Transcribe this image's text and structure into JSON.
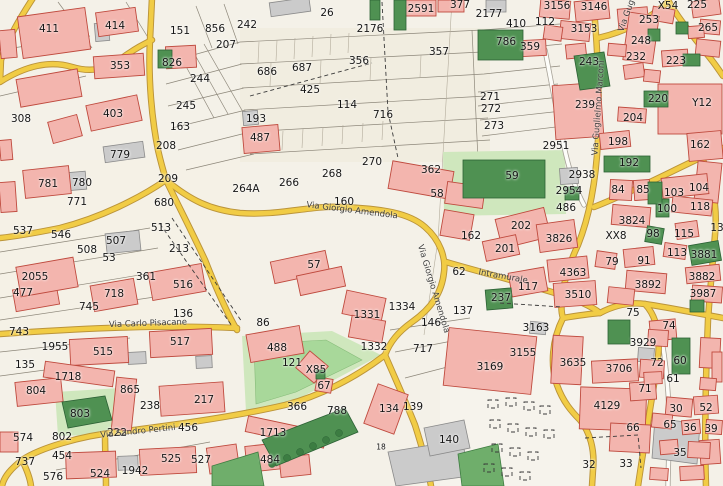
{
  "map": {
    "type": "cadastral-street-map",
    "palette": {
      "bg": "#f4f1e8",
      "road_yellow": "#f1cc45",
      "road_casing": "#bb943a",
      "building_pink": "#f3b5ae",
      "building_outline": "#bf4a3e",
      "green_dark": "#4f9152",
      "green_light": "#cfe7bd",
      "label_color": "#161616"
    },
    "street_labels": [
      {
        "text": "Via Giorgio Amendola",
        "x": 352,
        "y": 211,
        "angle": 7
      },
      {
        "text": "Via Giorgio Amendola",
        "x": 433,
        "y": 289,
        "angle": 73
      },
      {
        "text": "Via Guglielmo Marconi",
        "x": 599,
        "y": 108,
        "angle": -86
      },
      {
        "text": "Via Gug",
        "x": 627,
        "y": 16,
        "angle": -70
      },
      {
        "text": "Via Carlo Pisacane",
        "x": 148,
        "y": 324,
        "angle": -2
      },
      {
        "text": "Via Sandro Pertini",
        "x": 138,
        "y": 432,
        "angle": -6
      },
      {
        "text": "Intramurale",
        "x": 503,
        "y": 277,
        "angle": 10
      }
    ],
    "parcel_labels": [
      {
        "t": "411",
        "x": 49,
        "y": 29
      },
      {
        "t": "414",
        "x": 115,
        "y": 26
      },
      {
        "t": "151",
        "x": 180,
        "y": 31
      },
      {
        "t": "856",
        "x": 215,
        "y": 29
      },
      {
        "t": "242",
        "x": 247,
        "y": 25
      },
      {
        "t": "26",
        "x": 327,
        "y": 13
      },
      {
        "t": "2591",
        "x": 421,
        "y": 9
      },
      {
        "t": "377",
        "x": 460,
        "y": 5
      },
      {
        "t": "2176",
        "x": 370,
        "y": 29
      },
      {
        "t": "207",
        "x": 226,
        "y": 45
      },
      {
        "t": "353",
        "x": 120,
        "y": 66
      },
      {
        "t": "826",
        "x": 172,
        "y": 63
      },
      {
        "t": "244",
        "x": 200,
        "y": 79
      },
      {
        "t": "245",
        "x": 186,
        "y": 106
      },
      {
        "t": "403",
        "x": 113,
        "y": 114
      },
      {
        "t": "308",
        "x": 21,
        "y": 119
      },
      {
        "t": "163",
        "x": 180,
        "y": 127
      },
      {
        "t": "208",
        "x": 166,
        "y": 146
      },
      {
        "t": "779",
        "x": 120,
        "y": 155
      },
      {
        "t": "686",
        "x": 267,
        "y": 72
      },
      {
        "t": "687",
        "x": 302,
        "y": 68
      },
      {
        "t": "356",
        "x": 359,
        "y": 61
      },
      {
        "t": "357",
        "x": 439,
        "y": 52
      },
      {
        "t": "425",
        "x": 310,
        "y": 90
      },
      {
        "t": "114",
        "x": 347,
        "y": 105
      },
      {
        "t": "716",
        "x": 383,
        "y": 115
      },
      {
        "t": "193",
        "x": 256,
        "y": 119
      },
      {
        "t": "487",
        "x": 260,
        "y": 138
      },
      {
        "t": "270",
        "x": 372,
        "y": 162
      },
      {
        "t": "264A",
        "x": 246,
        "y": 189
      },
      {
        "t": "266",
        "x": 289,
        "y": 183
      },
      {
        "t": "268",
        "x": 332,
        "y": 174
      },
      {
        "t": "160",
        "x": 344,
        "y": 202
      },
      {
        "t": "2177",
        "x": 489,
        "y": 14
      },
      {
        "t": "410",
        "x": 516,
        "y": 24
      },
      {
        "t": "112",
        "x": 545,
        "y": 22
      },
      {
        "t": "3156",
        "x": 557,
        "y": 6
      },
      {
        "t": "3146",
        "x": 594,
        "y": 7
      },
      {
        "t": "X54",
        "x": 668,
        "y": 6
      },
      {
        "t": "225",
        "x": 697,
        "y": 5
      },
      {
        "t": "3153",
        "x": 584,
        "y": 29
      },
      {
        "t": "253",
        "x": 649,
        "y": 20
      },
      {
        "t": "265",
        "x": 708,
        "y": 28
      },
      {
        "t": "786",
        "x": 506,
        "y": 42
      },
      {
        "t": "359",
        "x": 530,
        "y": 47
      },
      {
        "t": "248",
        "x": 641,
        "y": 41
      },
      {
        "t": "232",
        "x": 636,
        "y": 57
      },
      {
        "t": "223",
        "x": 676,
        "y": 61
      },
      {
        "t": "243",
        "x": 589,
        "y": 62
      },
      {
        "t": "271",
        "x": 490,
        "y": 97
      },
      {
        "t": "272",
        "x": 491,
        "y": 109
      },
      {
        "t": "273",
        "x": 494,
        "y": 126
      },
      {
        "t": "239",
        "x": 585,
        "y": 105
      },
      {
        "t": "220",
        "x": 658,
        "y": 99
      },
      {
        "t": "Y12",
        "x": 702,
        "y": 103
      },
      {
        "t": "204",
        "x": 633,
        "y": 118
      },
      {
        "t": "198",
        "x": 618,
        "y": 142
      },
      {
        "t": "2951",
        "x": 556,
        "y": 146
      },
      {
        "t": "192",
        "x": 629,
        "y": 163
      },
      {
        "t": "162",
        "x": 700,
        "y": 145
      },
      {
        "t": "362",
        "x": 431,
        "y": 170
      },
      {
        "t": "58",
        "x": 437,
        "y": 194
      },
      {
        "t": "59",
        "x": 512,
        "y": 176
      },
      {
        "t": "781",
        "x": 48,
        "y": 184
      },
      {
        "t": "780",
        "x": 82,
        "y": 183
      },
      {
        "t": "771",
        "x": 77,
        "y": 202
      },
      {
        "t": "209",
        "x": 168,
        "y": 179
      },
      {
        "t": "680",
        "x": 164,
        "y": 203
      },
      {
        "t": "537",
        "x": 23,
        "y": 231
      },
      {
        "t": "546",
        "x": 61,
        "y": 235
      },
      {
        "t": "513",
        "x": 161,
        "y": 228
      },
      {
        "t": "507",
        "x": 116,
        "y": 241
      },
      {
        "t": "508",
        "x": 87,
        "y": 250
      },
      {
        "t": "53",
        "x": 109,
        "y": 258
      },
      {
        "t": "213",
        "x": 179,
        "y": 249
      },
      {
        "t": "2055",
        "x": 35,
        "y": 277
      },
      {
        "t": "477",
        "x": 23,
        "y": 293
      },
      {
        "t": "718",
        "x": 114,
        "y": 294
      },
      {
        "t": "361",
        "x": 146,
        "y": 277
      },
      {
        "t": "516",
        "x": 183,
        "y": 285
      },
      {
        "t": "136",
        "x": 183,
        "y": 314
      },
      {
        "t": "745",
        "x": 89,
        "y": 307
      },
      {
        "t": "57",
        "x": 314,
        "y": 265
      },
      {
        "t": "162",
        "x": 471,
        "y": 236
      },
      {
        "t": "202",
        "x": 521,
        "y": 226
      },
      {
        "t": "201",
        "x": 505,
        "y": 249
      },
      {
        "t": "3826",
        "x": 559,
        "y": 239
      },
      {
        "t": "2938",
        "x": 582,
        "y": 175
      },
      {
        "t": "2954",
        "x": 569,
        "y": 191
      },
      {
        "t": "486",
        "x": 566,
        "y": 208
      },
      {
        "t": "84",
        "x": 618,
        "y": 190
      },
      {
        "t": "85",
        "x": 643,
        "y": 190
      },
      {
        "t": "103",
        "x": 674,
        "y": 193
      },
      {
        "t": "104",
        "x": 699,
        "y": 188
      },
      {
        "t": "100",
        "x": 667,
        "y": 209
      },
      {
        "t": "118",
        "x": 700,
        "y": 207
      },
      {
        "t": "3824",
        "x": 632,
        "y": 221
      },
      {
        "t": "XX8",
        "x": 616,
        "y": 236
      },
      {
        "t": "98",
        "x": 653,
        "y": 234
      },
      {
        "t": "115",
        "x": 684,
        "y": 234
      },
      {
        "t": "13",
        "x": 717,
        "y": 228
      },
      {
        "t": "113",
        "x": 677,
        "y": 253
      },
      {
        "t": "3881",
        "x": 704,
        "y": 255
      },
      {
        "t": "79",
        "x": 612,
        "y": 262
      },
      {
        "t": "91",
        "x": 644,
        "y": 261
      },
      {
        "t": "3892",
        "x": 648,
        "y": 285
      },
      {
        "t": "3882",
        "x": 702,
        "y": 277
      },
      {
        "t": "3987",
        "x": 703,
        "y": 294
      },
      {
        "t": "62",
        "x": 459,
        "y": 272
      },
      {
        "t": "117",
        "x": 528,
        "y": 287
      },
      {
        "t": "237",
        "x": 501,
        "y": 298
      },
      {
        "t": "4363",
        "x": 573,
        "y": 273
      },
      {
        "t": "3510",
        "x": 578,
        "y": 295
      },
      {
        "t": "75",
        "x": 633,
        "y": 313
      },
      {
        "t": "1334",
        "x": 402,
        "y": 307
      },
      {
        "t": "1331",
        "x": 367,
        "y": 315
      },
      {
        "t": "1332",
        "x": 374,
        "y": 347
      },
      {
        "t": "137",
        "x": 463,
        "y": 311
      },
      {
        "t": "146",
        "x": 431,
        "y": 323
      },
      {
        "t": "717",
        "x": 423,
        "y": 349
      },
      {
        "t": "743",
        "x": 19,
        "y": 332
      },
      {
        "t": "1955",
        "x": 55,
        "y": 347
      },
      {
        "t": "135",
        "x": 25,
        "y": 365
      },
      {
        "t": "515",
        "x": 103,
        "y": 352
      },
      {
        "t": "517",
        "x": 180,
        "y": 342
      },
      {
        "t": "1718",
        "x": 68,
        "y": 377
      },
      {
        "t": "804",
        "x": 36,
        "y": 391
      },
      {
        "t": "865",
        "x": 130,
        "y": 390
      },
      {
        "t": "238",
        "x": 150,
        "y": 406
      },
      {
        "t": "217",
        "x": 204,
        "y": 400
      },
      {
        "t": "803",
        "x": 80,
        "y": 414
      },
      {
        "t": "802",
        "x": 62,
        "y": 437
      },
      {
        "t": "574",
        "x": 23,
        "y": 438
      },
      {
        "t": "454",
        "x": 62,
        "y": 456
      },
      {
        "t": "737",
        "x": 25,
        "y": 462
      },
      {
        "t": "576",
        "x": 53,
        "y": 477
      },
      {
        "t": "524",
        "x": 100,
        "y": 474
      },
      {
        "t": "1942",
        "x": 135,
        "y": 471
      },
      {
        "t": "525",
        "x": 171,
        "y": 459
      },
      {
        "t": "527",
        "x": 201,
        "y": 460
      },
      {
        "t": "222",
        "x": 117,
        "y": 433
      },
      {
        "t": "456",
        "x": 188,
        "y": 428
      },
      {
        "t": "86",
        "x": 263,
        "y": 323
      },
      {
        "t": "488",
        "x": 277,
        "y": 348
      },
      {
        "t": "121",
        "x": 292,
        "y": 363
      },
      {
        "t": "X85",
        "x": 316,
        "y": 370
      },
      {
        "t": "67",
        "x": 324,
        "y": 386
      },
      {
        "t": "366",
        "x": 297,
        "y": 407
      },
      {
        "t": "788",
        "x": 337,
        "y": 411
      },
      {
        "t": "1713",
        "x": 273,
        "y": 433
      },
      {
        "t": "484",
        "x": 270,
        "y": 460
      },
      {
        "t": "134",
        "x": 389,
        "y": 409
      },
      {
        "t": "139",
        "x": 413,
        "y": 407
      },
      {
        "t": "140",
        "x": 449,
        "y": 440
      },
      {
        "t": "18",
        "x": 381,
        "y": 447,
        "s": "small"
      },
      {
        "t": "3163",
        "x": 536,
        "y": 328
      },
      {
        "t": "3155",
        "x": 523,
        "y": 353
      },
      {
        "t": "3169",
        "x": 490,
        "y": 367
      },
      {
        "t": "3635",
        "x": 573,
        "y": 363
      },
      {
        "t": "3929",
        "x": 643,
        "y": 343
      },
      {
        "t": "3706",
        "x": 619,
        "y": 369
      },
      {
        "t": "74",
        "x": 669,
        "y": 326
      },
      {
        "t": "72",
        "x": 657,
        "y": 363
      },
      {
        "t": "60",
        "x": 680,
        "y": 361
      },
      {
        "t": "61",
        "x": 673,
        "y": 379
      },
      {
        "t": "71",
        "x": 645,
        "y": 389
      },
      {
        "t": "4129",
        "x": 607,
        "y": 406
      },
      {
        "t": "30",
        "x": 676,
        "y": 409
      },
      {
        "t": "52",
        "x": 706,
        "y": 408
      },
      {
        "t": "65",
        "x": 670,
        "y": 425
      },
      {
        "t": "66",
        "x": 633,
        "y": 428
      },
      {
        "t": "36",
        "x": 690,
        "y": 428
      },
      {
        "t": "39",
        "x": 711,
        "y": 429
      },
      {
        "t": "35",
        "x": 680,
        "y": 453
      },
      {
        "t": "32",
        "x": 589,
        "y": 465
      },
      {
        "t": "33",
        "x": 626,
        "y": 464
      }
    ]
  }
}
